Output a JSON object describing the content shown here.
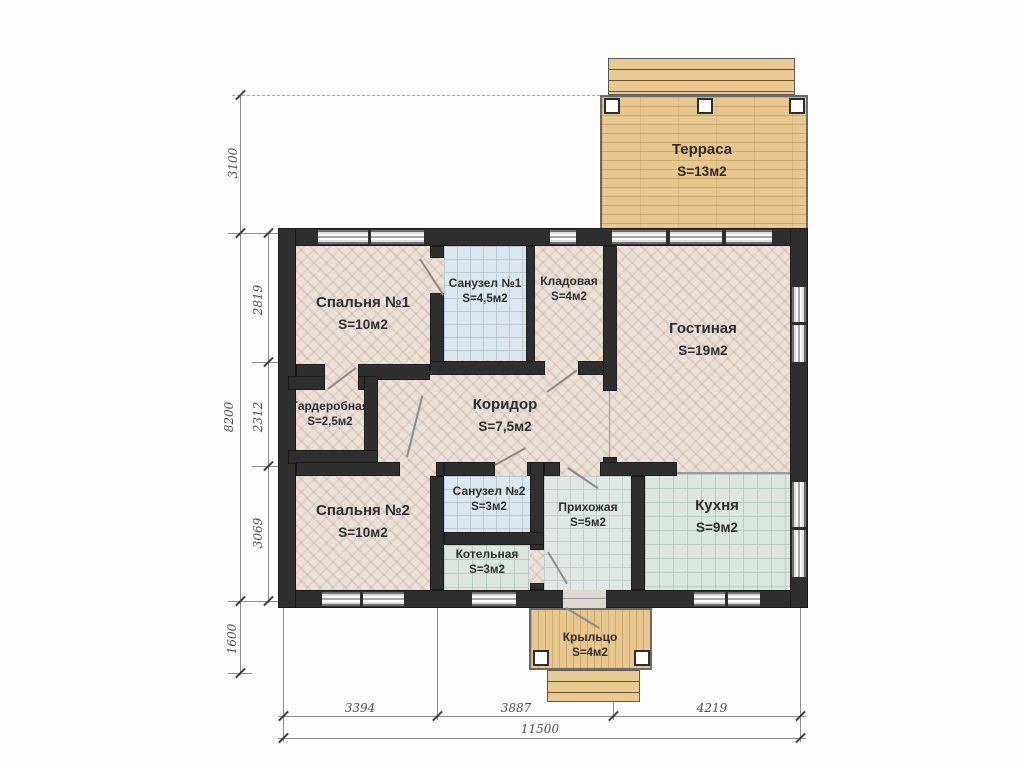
{
  "rooms": [
    {
      "id": "terrace",
      "name": "Терраса",
      "area": "S=13м2"
    },
    {
      "id": "bedroom1",
      "name": "Спальня №1",
      "area": "S=10м2"
    },
    {
      "id": "bath1",
      "name": "Санузел №1",
      "area": "S=4,5м2"
    },
    {
      "id": "storage",
      "name": "Кладовая",
      "area": "S=4м2"
    },
    {
      "id": "living",
      "name": "Гостиная",
      "area": "S=19м2"
    },
    {
      "id": "wardrobe",
      "name": "Гардеробная",
      "area": "S=2,5м2"
    },
    {
      "id": "corridor",
      "name": "Коридор",
      "area": "S=7,5м2"
    },
    {
      "id": "bedroom2",
      "name": "Спальня №2",
      "area": "S=10м2"
    },
    {
      "id": "bath2",
      "name": "Санузел №2",
      "area": "S=3м2"
    },
    {
      "id": "hallway",
      "name": "Прихожая",
      "area": "S=5м2"
    },
    {
      "id": "kitchen",
      "name": "Кухня",
      "area": "S=9м2"
    },
    {
      "id": "boiler",
      "name": "Котельная",
      "area": "S=3м2"
    },
    {
      "id": "porch",
      "name": "Крыльцо",
      "area": "S=4м2"
    }
  ],
  "dimensions": {
    "left_terrace": "3100",
    "left_total": "8200",
    "left_inner": [
      "2819",
      "2312",
      "3069"
    ],
    "left_porch": "1600",
    "bottom_segments": [
      "3394",
      "3887",
      "4219"
    ],
    "bottom_total": "11500"
  },
  "colors": {
    "wall": "#2e2e2e",
    "wood_floor": "#ebe1d6",
    "tile_floor": "#dbe7ee",
    "deck_wood": "#e8c78e",
    "dimension_text": "#4c4c4c"
  }
}
